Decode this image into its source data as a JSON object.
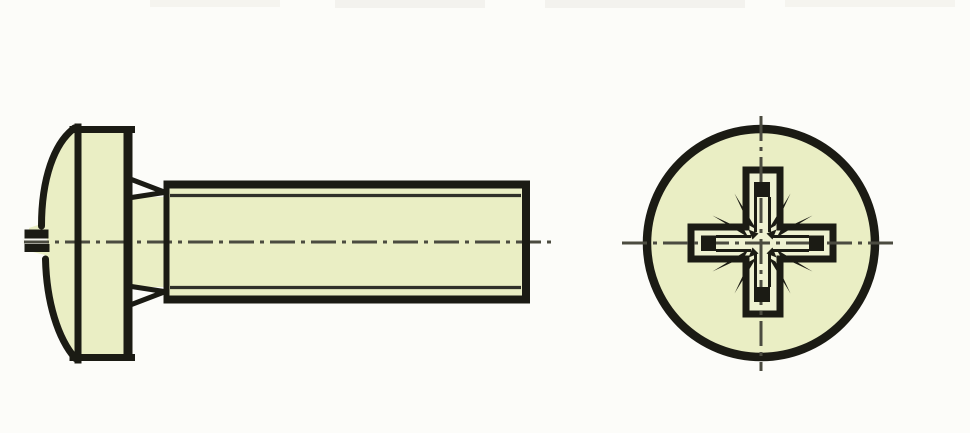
{
  "drawing": {
    "subject": "pan head machine screw technical drawing",
    "views": [
      {
        "id": "side-view",
        "name": "screw-side-view"
      },
      {
        "id": "end-view",
        "name": "head-end-view-pozidriv-recess"
      }
    ]
  },
  "colors": {
    "background": "#fcfcf9",
    "part-fill": "#eaeec4",
    "recess-fill": "#eef1d1",
    "line": "#1b1b14",
    "thin-line": "#30302a",
    "centerline": "#4b4b40",
    "slot-gap": "#f7f7f1",
    "artifact": "#f2f1ec"
  }
}
